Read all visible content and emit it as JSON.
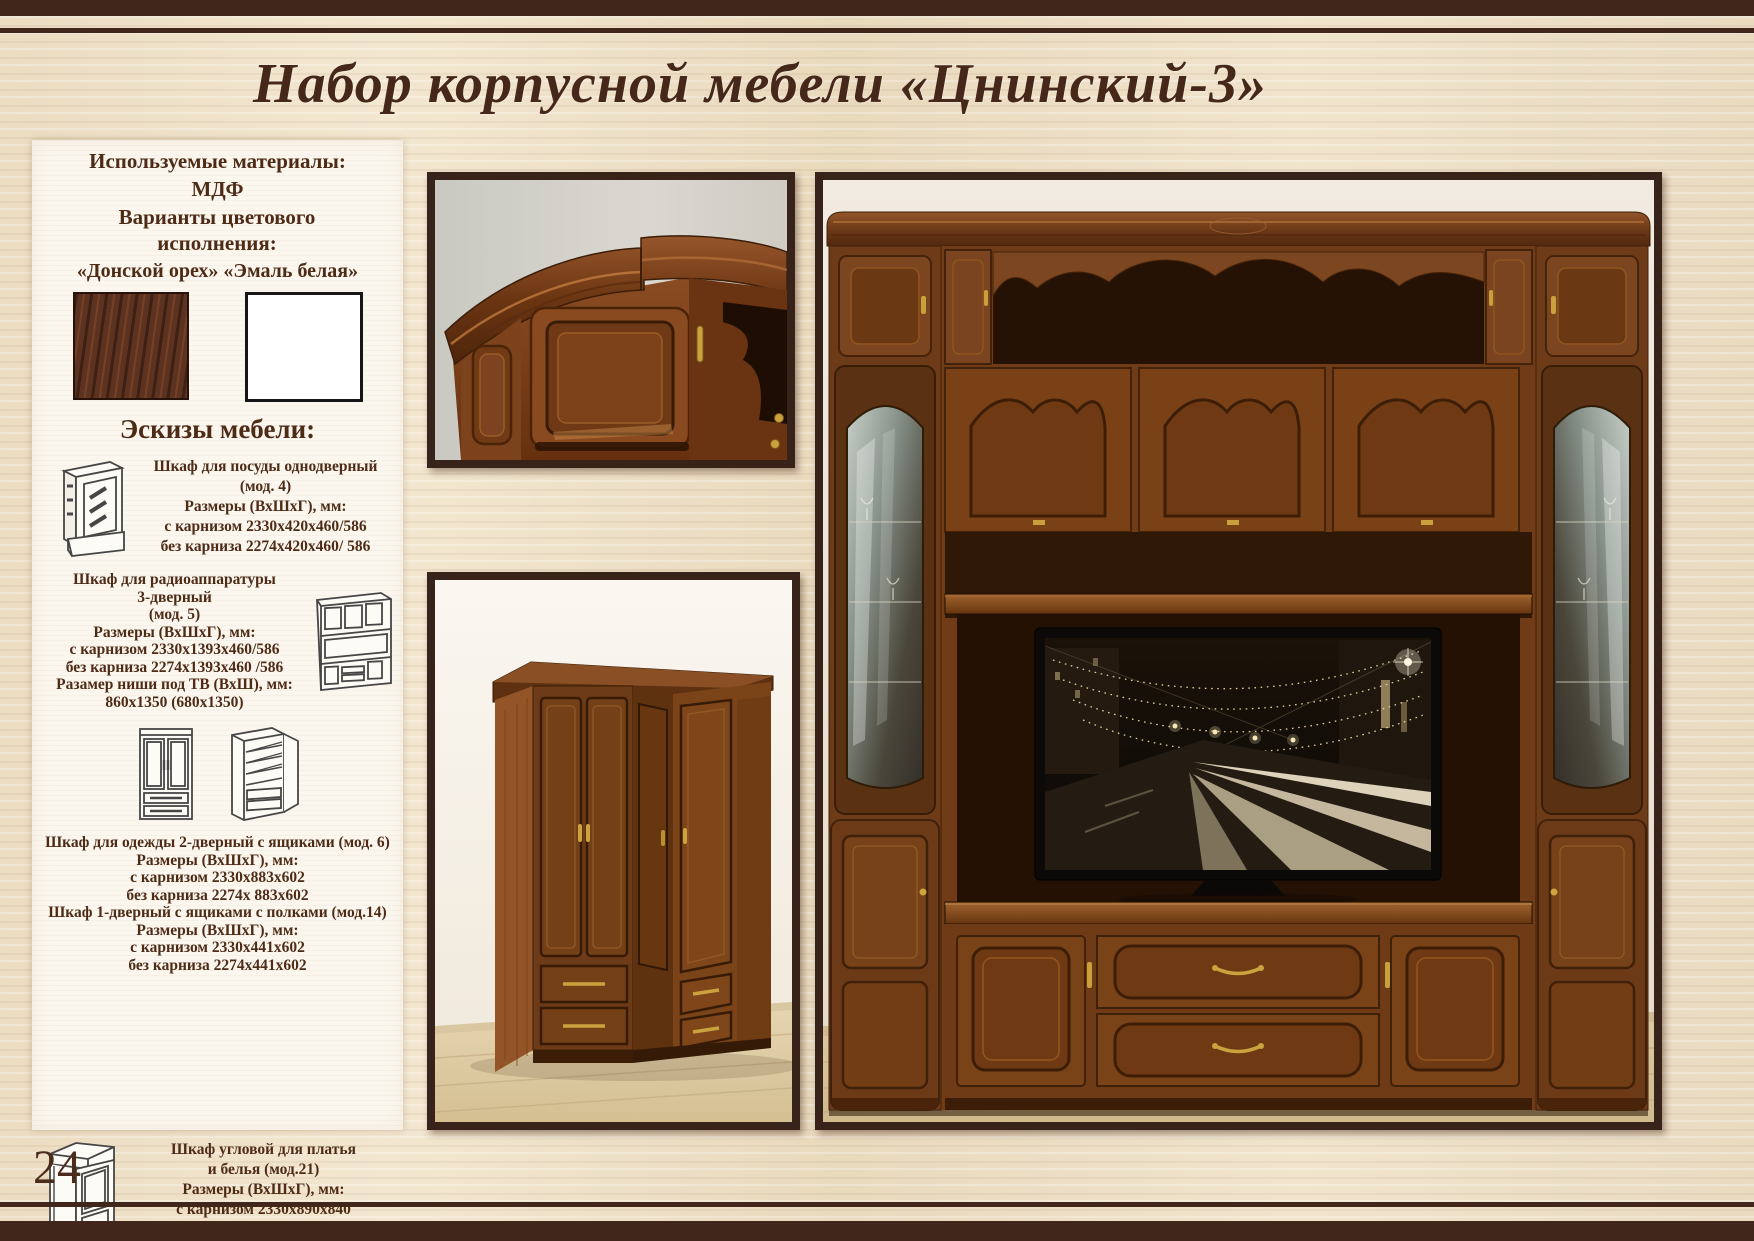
{
  "page": {
    "title": "Набор корпусной мебели «Цнинский-3»",
    "page_number": "24"
  },
  "colors": {
    "header_band": "#40261b",
    "title_text": "#46281a",
    "body_text": "#4e2b17",
    "photo_frame": "#38231a",
    "wood_background": "#eddfc7",
    "panel_background": "#fbf7ef",
    "swatch_walnut": "#5c3220",
    "swatch_white": "#ffffff"
  },
  "sidebar": {
    "materials_heading": "Используемые материалы:",
    "material": "МДФ",
    "colors_heading": "Варианты цветового исполнения:",
    "color_names": "«Донской орех» «Эмаль белая»",
    "swatches": [
      {
        "label": "Донской орех",
        "hex": "#5c3220"
      },
      {
        "label": "Эмаль белая",
        "hex": "#ffffff"
      }
    ],
    "sketches_heading": "Эскизы мебели:",
    "specs": [
      {
        "lines": [
          "Шкаф для посуды однодверный",
          "(мод. 4)",
          "Размеры (ВхШхГ), мм:",
          "с карнизом 2330х420х460/586",
          "без карниза 2274х420х460/ 586"
        ]
      },
      {
        "lines": [
          "Шкаф для радиоаппаратуры",
          "3-дверный",
          "(мод. 5)",
          "Размеры (ВхШхГ), мм:",
          "с карнизом 2330х1393х460/586",
          "без карниза 2274х1393х460 /586",
          "Разамер ниши под ТВ (ВхШ), мм:",
          "860х1350 (680х1350)"
        ]
      },
      {
        "lines": [
          "Шкаф для одежды 2-дверный с ящиками (мод. 6)",
          "Размеры (ВхШхГ), мм:",
          "с карнизом 2330х883х602",
          "без карниза 2274х 883х602",
          "Шкаф 1-дверный с ящиками с полками (мод.14)",
          "Размеры (ВхШхГ), мм:",
          "с карнизом 2330х441х602",
          "без карниза 2274х441х602"
        ]
      },
      {
        "lines": [
          "Шкаф угловой для платья",
          "и белья (мод.21)",
          "Размеры (ВхШхГ), мм:",
          "с карнизом 2330х890х840",
          "без карниза 2274х890х840"
        ]
      }
    ]
  }
}
